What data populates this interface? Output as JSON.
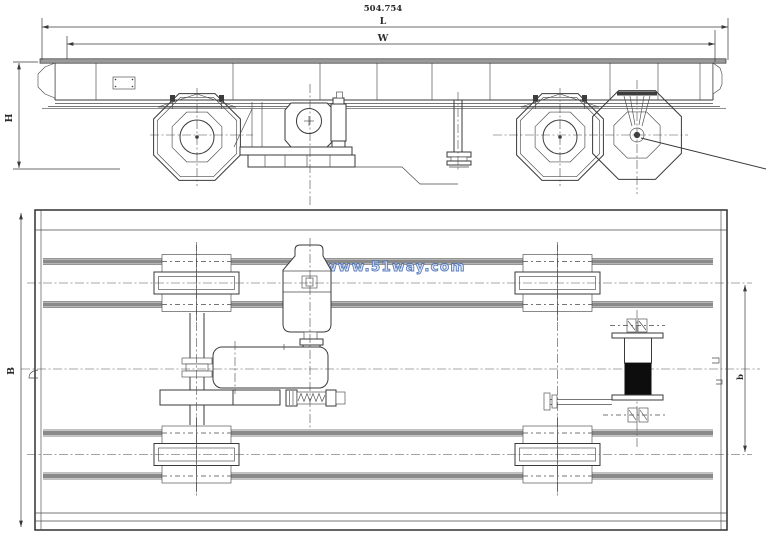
{
  "drawing": {
    "labels": {
      "total_dimension": "504.754",
      "length": "L",
      "width": "W",
      "height": "H",
      "breadth": "B",
      "gauge": "b"
    },
    "watermark": {
      "text": "www.51way.com",
      "color": "#4a6fb5"
    },
    "colors": {
      "line": "#3a3a3a",
      "rail": "#8a8a8a",
      "drum": "#0d0d0d",
      "flange": "#9a9a9a"
    }
  }
}
